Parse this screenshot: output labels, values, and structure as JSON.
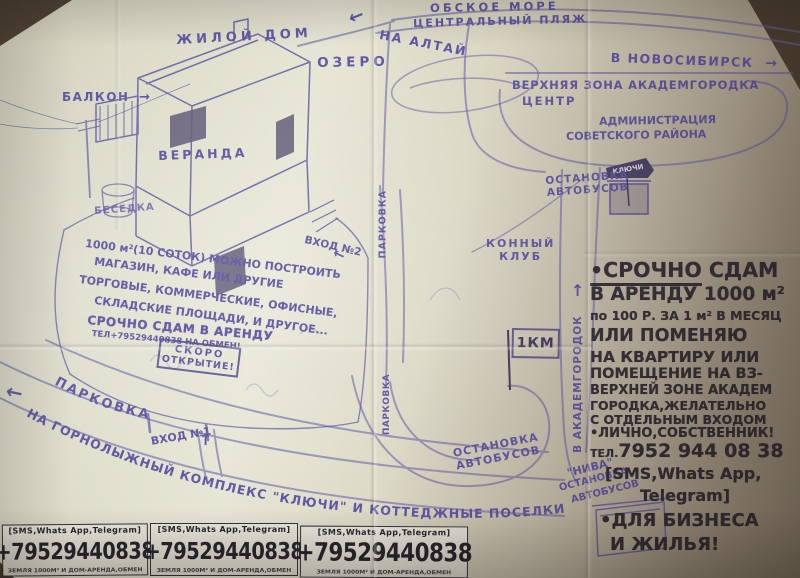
{
  "labels": {
    "sea": "ОБСКОЕ МОРЕ",
    "beach": "ЦЕНТРАЛЬНЫЙ ПЛЯЖ",
    "to_altai": "НА АЛТАЙ",
    "to_nsk": "В НОВОСИБИРСК",
    "upper_zone": "ВЕРХНЯЯ ЗОНА АКАДЕМГОРОДКА",
    "center": "ЦЕНТР",
    "admin1": "АДМИНИСТРАЦИЯ",
    "admin2": "СОВЕТСКОГО РАЙОНА",
    "bus_stop_a": "ОСТАНОВКА",
    "bus_stop_b": "АВТОБУСОВ",
    "sign_klyuchi": "КЛЮЧИ",
    "horse1": "КОННЫЙ",
    "horse2": "КЛУБ",
    "house": "ЖИЛОЙ ДОМ",
    "balcony": "БАЛКОН",
    "lake": "ОЗЕРО",
    "veranda": "ВЕРАНДА",
    "gazebo": "БЕСЕДКА",
    "pitch1": "1000 м²(10 СОТОК) МОЖНО ПОСТРОИТЬ",
    "pitch2": "МАГАЗИН, КАФЕ ИЛИ ДРУГИЕ",
    "pitch3": "ТОРГОВЫЕ, КОММЕРЧЕСКИЕ, ОФИСНЫЕ,",
    "pitch4": "СКЛАДСКИЕ ПЛОЩАДИ, И ДРУГОЕ...",
    "rent1": "СРОЧНО СДАМ В АРЕНДУ",
    "rent2": "ТЕЛ+79529440838 НА ОБМЕН!",
    "soon1": "СКОРО",
    "soon2": "ОТКРЫТИЕ!",
    "entrance2": "ВХОД №2",
    "entrance1": "ВХОД №1",
    "parking_curve": "ПАРКОВКА",
    "parking_v1": "ПАРКОВКА",
    "parking_v2": "ПАРКОВКА",
    "to_akadem": "В АКАДЕМГОРОДОК",
    "km": "1КМ",
    "niva": "\"НИВА\"",
    "road_to": "НА ГОРНОЛЫЖНЫЙ КОМПЛЕКС \"КЛЮЧИ\" И КОТТЕДЖНЫЕ ПОСЕЛКИ"
  },
  "glyphs": {
    "left": "←",
    "right": "→",
    "up": "↑"
  },
  "ad": {
    "l1a": "•СРОЧНО",
    "l1b": " СДАМ",
    "l2": "В АРЕНДУ 1000 м²",
    "l3": "по 100 Р. ЗА 1 м² В МЕСЯЦ",
    "l4": "ИЛИ ПОМЕНЯЮ",
    "l5": "НА КВАРТИРУ ИЛИ",
    "l6": "ПОМЕЩЕНИЕ НА ВЗ-",
    "l7": "ВЕРХНЕЙ ЗОНЕ АКАДЕМ",
    "l8": "ГОРОДКА,ЖЕЛАТЕЛЬНО",
    "l9": "С ОТДЕЛЬНЫМ ВХОДОМ",
    "l10": "•ЛИЧНО,СОБСТВЕННИК!",
    "l11a": "ТЕЛ.",
    "l11b": "7952 944 08 38",
    "l12": "[SMS,Whats App,",
    "l13": "Telegram]",
    "l14": "•ДЛЯ БИЗНЕСА",
    "l15": "И ЖИЛЬЯ!"
  },
  "strip": {
    "header": "[SMS,Whats App,Telegram]",
    "phone": "+79529440838",
    "footer": "ЗЕМЛЯ 1000М² И ДОМ-АРЕНДА,ОБМЕН"
  },
  "colors": {
    "ink": "#5e55a3",
    "marker": "#312d36",
    "paper": "#dcdbc8"
  }
}
